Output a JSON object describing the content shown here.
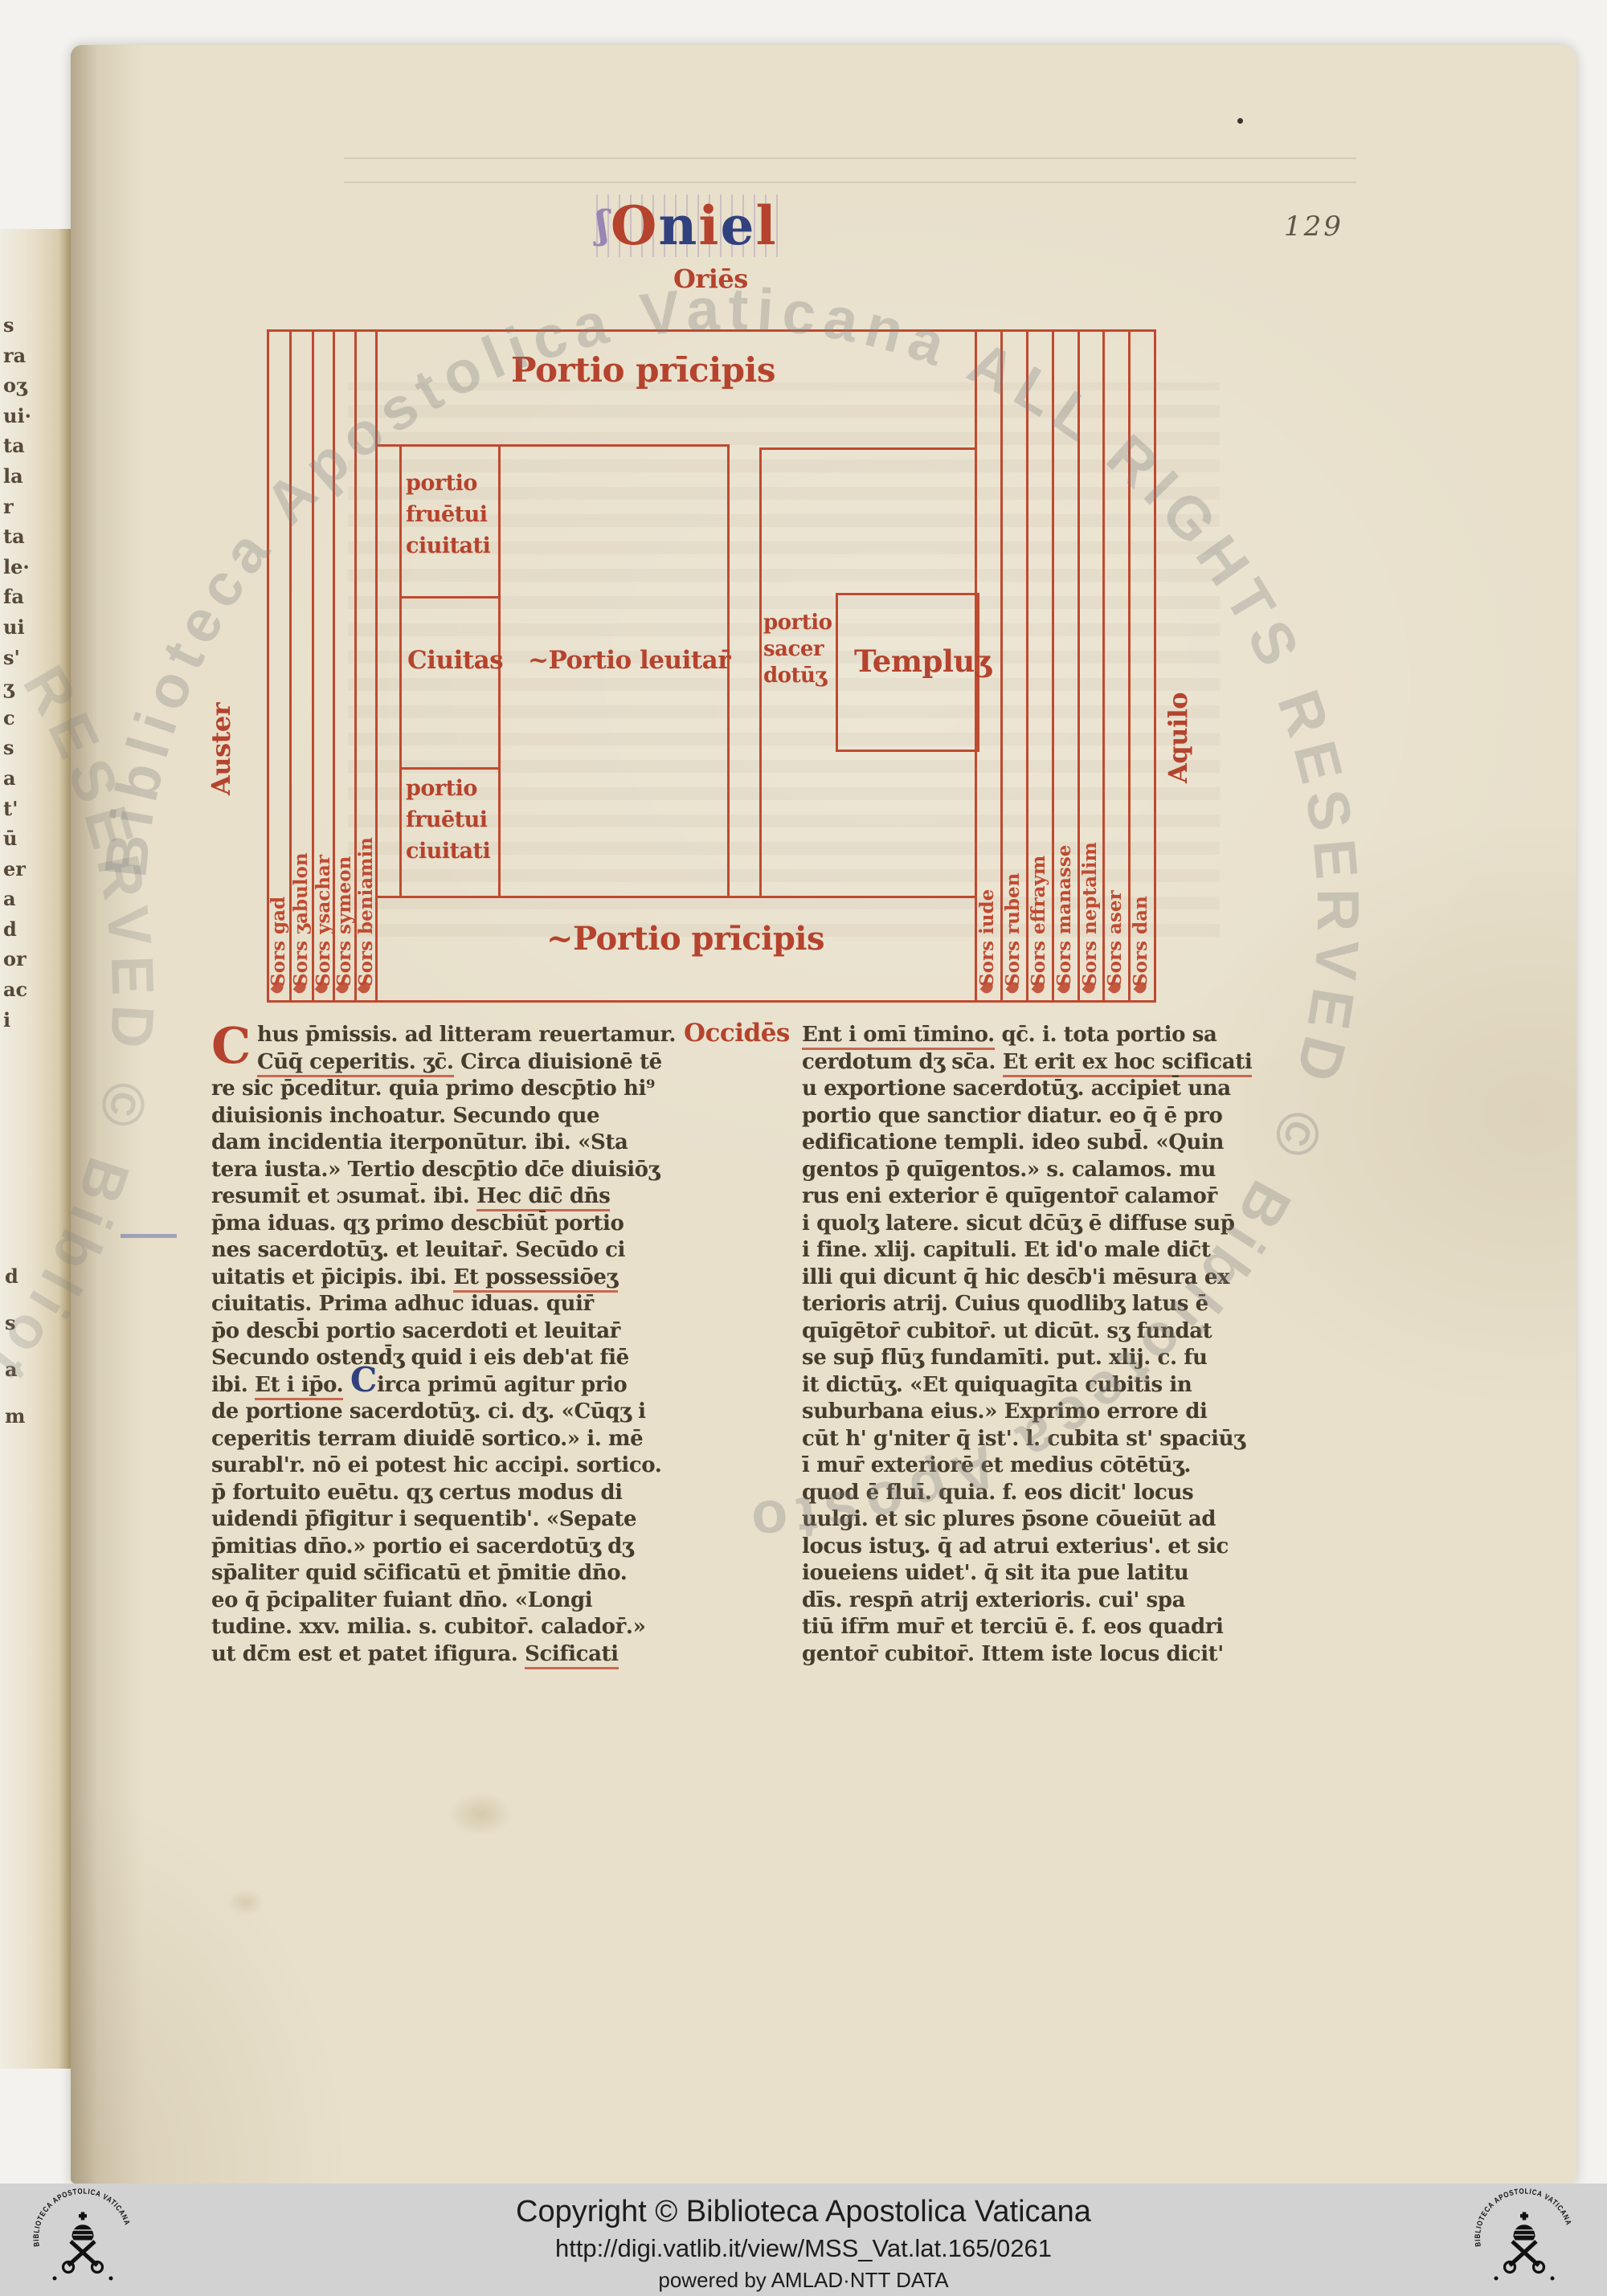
{
  "colors": {
    "red_ink": "#b5432d",
    "blue_ink": "#31417e",
    "brown_ink": "#463b2c",
    "parchment": "#e8e0cb",
    "footer_bg": "#d2d2d2",
    "watermark_gray": "#7e7e7e"
  },
  "scan": {
    "folio_number": "129"
  },
  "header": {
    "title_letters": [
      [
        "ʃ",
        "fl"
      ],
      [
        "O",
        "r"
      ],
      [
        "n",
        "b"
      ],
      [
        "i",
        "r"
      ],
      [
        "e",
        "b"
      ],
      [
        "l",
        "r"
      ]
    ]
  },
  "diagram": {
    "labels": {
      "oriens": "Oriēs",
      "occidens": "Occidēs",
      "auster": "Auster",
      "aquilo": "Aquilo",
      "portio_principis_top": "Portio prīcipis",
      "portio_principis_bottom": "~Portio prīcipis",
      "portio_fructui_top": [
        "portio",
        "fruētui",
        "ciuitati"
      ],
      "civitas": "Ciuitas",
      "portio_levitarum": "~Portio leuitar̄",
      "portio_sacerdotum": [
        "portio",
        "sacer",
        "dotūʒ"
      ],
      "templum": "Templuʒ",
      "portio_fructui_bottom": [
        "portio",
        "fruētui",
        "ciuitati"
      ]
    },
    "tribes_left": [
      "Sors gad",
      "Sors ʒabulon",
      "Sors ysachar",
      "Sors symeon",
      "Sors beniamin"
    ],
    "tribes_right": [
      "Sors iude",
      "Sors ruben",
      "Sors effraym",
      "Sors manasse",
      "Sors neptalim",
      "Sors aser",
      "Sors dan"
    ]
  },
  "manuscript_text": {
    "left_column": {
      "initial": "C",
      "lines": [
        "hus p̄missis. ad litteram reuertamur.",
        "«Cūq̄ ceperitis. ʒc̄.» Circa diuisionē tē",
        "re sic p̄ceditur. quia primo descp̄tio hi⁹",
        "diuisionis inchoatur. Secundo que",
        "dam incidentia iterponūtur. ibi. «Sta",
        "tera iusta.» Tertio descp̄tio dc̄e diuisiōʒ",
        "resumit̄ et ɔsumat̄. ibi. «Hec dic̄ dn̄s»",
        "p̄ma iduas. qʒ primo descbiūt̄ portio",
        "nes sacerdotūʒ. et leuitar̄. Secūdo ci",
        "uitatis et p̄icipis. ibi. «Et possessiōeʒ»",
        "ciuitatis. Prima adhuc iduas. quir̄",
        "p̄o descb̄i portio sacerdoti et leuitar̄",
        "Secundo ostend̄ʒ quid i eis deb'at fiē",
        "ibi. «Et i ip̄o.» ⟨C⟩irca primū agitur prio",
        "de portione sacerdotūʒ. ci. dʒ. «Cūqʒ i",
        "ceperitis terram diuidē sortico.» i. mē",
        "surabl'r. nō ei potest hic accipi. sortico.",
        "p̄ fortuito euētu. qʒ certus modus di",
        "uidendi p̄figitur i sequentib'. «Sepate",
        "p̄mitias dn̄o.» portio ei sacerdotūʒ dʒ",
        "sp̄aliter quid sc̄ificatū et p̄mitie dn̄o.",
        "eo q̄ p̄cipaliter fuiant dn̄o. «Longi",
        "tudine. xxv. milia. s. cubitor̄. calador̄.»",
        "ut dc̄m est et patet ifigura. «Scificati»"
      ]
    },
    "right_column": {
      "lines": [
        "«Ent i omī tīmino.» qc̄. i. tota portio sa",
        "cerdotum dʒ sc̄a. «Et erit ex hoc scificati»",
        "u exportione sacerdotūʒ. accipiet̄ una",
        "portio que sanctior diatur. eo q̄ ē pro",
        "edificatione templi. ideo subd̄. «Quin",
        "gentos p̄ quīgentos.» s. calamos. mu",
        "rus eni exterior ē quīgentor̄ calamor̄",
        "i quolʒ latere. sicut dc̄ūʒ ē diffuse sup̄",
        "i fine. xlij. capituli. Et id'o male dic̄t",
        "illi qui dicunt q̄ hic desc̄b'i mēsura ex",
        "terioris atrij. Cuius quodlibʒ latus ē",
        "quīgētor̄ cubitor̄. ut dicūt. sʒ fundat",
        "se sup̄ flūʒ fundamīti. put. xlij. c. fu",
        "it dictūʒ. «Et quiquagīta cubitis in",
        "suburbana eius.» Exprimo errore di",
        "cūt h' g'niter q̄ ist'. l. cubita st' spaciūʒ",
        "ī mur̄ exteriorē et medius cōtētūʒ.",
        "quod ē fluī. quia. f. eos dicit' locus",
        "uulgi. et sic plures p̄sone cōueiūt ad",
        "locus istuʒ. q̄ ad atrui exterius'. et sic",
        "ioueiens uidet'. q̄ sit ita pue latitu",
        "dīs. respn̄ atrij exterioris. cui' spa",
        "tiū ifr̄m mur̄ et terciū ē. f. eos quadri",
        "gentor̄ cubitor̄. Ittem iste locus dicit'"
      ]
    }
  },
  "margin_fragments": [
    "s",
    "ra",
    "oʒ",
    "ui·",
    "ta",
    "la",
    "r",
    "ta",
    "le·",
    "fa",
    "ui",
    "s'",
    "ʒ",
    "c",
    "s",
    "a",
    "t'",
    "ū",
    "er",
    "a",
    "d",
    "or",
    "ac",
    "i"
  ],
  "margin_fragments2": [
    "d",
    "s",
    "a",
    "m"
  ],
  "watermark": {
    "circle_text": "Biblioteca  Apostolica  Vaticana    ALL  RIGHTS  RESERVED    ©    Biblioteca  Apostolica",
    "partial_text": "RESERVED    ©    Bibliot"
  },
  "footer": {
    "copyright": "Copyright © Biblioteca Apostolica Vaticana",
    "url": "http://digi.vatlib.it/view/MSS_Vat.lat.165/0261",
    "powered_by": "powered by AMLAD·NTT DATA",
    "logo_ring_text": "BIBLIOTECA APOSTOLICA VATICANA"
  }
}
